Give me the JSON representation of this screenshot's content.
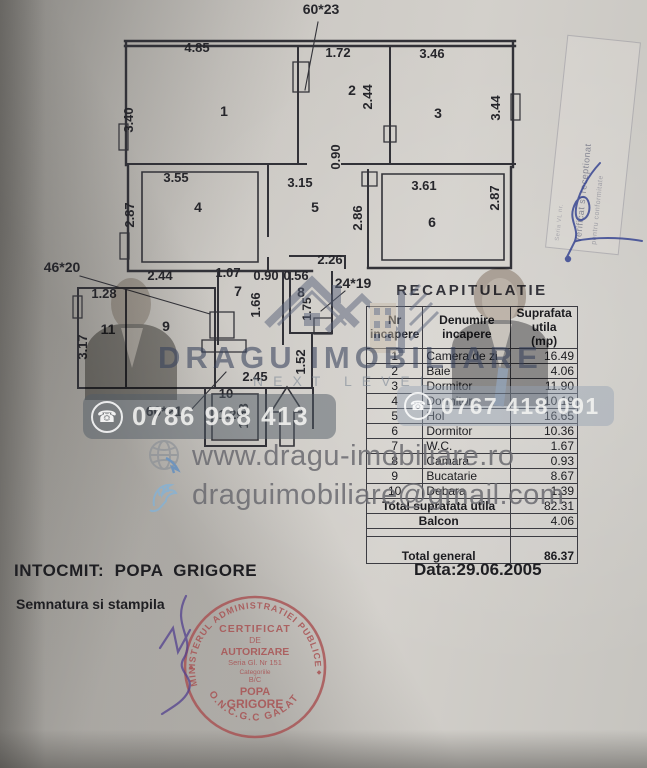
{
  "plan": {
    "labels": [
      {
        "t": "60*23",
        "x": 321,
        "y": 14,
        "s": 14
      },
      {
        "t": "4.85",
        "x": 197,
        "y": 52
      },
      {
        "t": "1.72",
        "x": 338,
        "y": 57
      },
      {
        "t": "3.46",
        "x": 432,
        "y": 58
      },
      {
        "t": "1",
        "x": 224,
        "y": 116,
        "s": 14
      },
      {
        "t": "2",
        "x": 352,
        "y": 95,
        "s": 14
      },
      {
        "t": "3",
        "x": 438,
        "y": 118,
        "s": 14
      },
      {
        "t": "3.40",
        "x": 133,
        "y": 120,
        "r": -90
      },
      {
        "t": "2.44",
        "x": 372,
        "y": 97,
        "r": -90
      },
      {
        "t": "3.44",
        "x": 500,
        "y": 108,
        "r": -90
      },
      {
        "t": "0.90",
        "x": 340,
        "y": 157,
        "r": -90
      },
      {
        "t": "3.55",
        "x": 176,
        "y": 182
      },
      {
        "t": "3.15",
        "x": 300,
        "y": 187
      },
      {
        "t": "3.61",
        "x": 424,
        "y": 190
      },
      {
        "t": "4",
        "x": 198,
        "y": 212,
        "s": 14
      },
      {
        "t": "5",
        "x": 315,
        "y": 212,
        "s": 14
      },
      {
        "t": "6",
        "x": 432,
        "y": 227,
        "s": 14
      },
      {
        "t": "2.87",
        "x": 134,
        "y": 215,
        "r": -90
      },
      {
        "t": "2.86",
        "x": 362,
        "y": 218,
        "r": -90
      },
      {
        "t": "2.87",
        "x": 499,
        "y": 198,
        "r": -90
      },
      {
        "t": "2.44",
        "x": 160,
        "y": 280
      },
      {
        "t": "1.07",
        "x": 228,
        "y": 277
      },
      {
        "t": "0.90",
        "x": 266,
        "y": 280
      },
      {
        "t": "0.56",
        "x": 296,
        "y": 280
      },
      {
        "t": "2.26",
        "x": 330,
        "y": 264
      },
      {
        "t": "46*20",
        "x": 62,
        "y": 272,
        "s": 14
      },
      {
        "t": "1.28",
        "x": 104,
        "y": 298
      },
      {
        "t": "11",
        "x": 108,
        "y": 334,
        "s": 14
      },
      {
        "t": "9",
        "x": 166,
        "y": 331,
        "s": 14
      },
      {
        "t": "3.17",
        "x": 87,
        "y": 347,
        "r": -90
      },
      {
        "t": "7",
        "x": 238,
        "y": 296,
        "s": 14
      },
      {
        "t": "8",
        "x": 301,
        "y": 297,
        "s": 14
      },
      {
        "t": "1.66",
        "x": 260,
        "y": 305,
        "r": -90
      },
      {
        "t": "1.75",
        "x": 311,
        "y": 309,
        "r": -90,
        "s": 12
      },
      {
        "t": "24*19",
        "x": 353,
        "y": 288,
        "s": 14
      },
      {
        "t": "1.52",
        "x": 305,
        "y": 362,
        "r": -90
      },
      {
        "t": "2.45",
        "x": 255,
        "y": 381
      },
      {
        "t": "10",
        "x": 226,
        "y": 398
      },
      {
        "t": "1.29",
        "x": 231,
        "y": 419
      },
      {
        "t": "1.08",
        "x": 248,
        "y": 416,
        "r": -90
      },
      {
        "t": "60*21",
        "x": 164,
        "y": 416,
        "s": 14
      }
    ]
  },
  "table": {
    "title": "RECAPITULATIE",
    "headers": {
      "col1_l1": "Nr",
      "col1_l2": "incapere",
      "col2_l1": "Denumire",
      "col2_l2": "incapere",
      "col3_l1": "Suprafata utila",
      "col3_l2": "(mp)"
    },
    "rows": [
      {
        "nr": "1",
        "name": "Camera de zi",
        "area": "16.49"
      },
      {
        "nr": "2",
        "name": "Baie",
        "area": "4.06"
      },
      {
        "nr": "3",
        "name": "Dormitor",
        "area": "11.90"
      },
      {
        "nr": "4",
        "name": "Dormitor",
        "area": "10.19"
      },
      {
        "nr": "5",
        "name": "Hol",
        "area": "16.65"
      },
      {
        "nr": "6",
        "name": "Dormitor",
        "area": "10.36"
      },
      {
        "nr": "7",
        "name": "W.C.",
        "area": "1.67"
      },
      {
        "nr": "8",
        "name": "Camara",
        "area": "0.93"
      },
      {
        "nr": "9",
        "name": "Bucatarie",
        "area": "8.67"
      },
      {
        "nr": "10",
        "name": "Debara",
        "area": "1.39"
      }
    ],
    "totals": {
      "utila_label": "Total suprafata utila",
      "utila": "82.31",
      "balcon_label": "Balcon",
      "balcon": "4.06",
      "general_label": "Total  general",
      "general": "86.37"
    }
  },
  "watermark": {
    "brand": "DRAGU IMOBILIARE",
    "tagline": "NEXT LEVEL",
    "phone_left": "0786 968 413",
    "phone_right": "0767 418 091",
    "phone_icon": "☎",
    "website": "www.dragu-imobiliare.ro",
    "email": "draguimobiliare@gmail.com"
  },
  "footer": {
    "intocmit": "INTOCMIT:  POPA  GRIGORE",
    "date": "Data:29.06.2005",
    "semnatura": "Semnatura si stampila"
  },
  "stamp": {
    "arc_top": "MINISTERUL ADMINISTRATIEI PUBLICE",
    "arc_bottom": "O.N.C.G.C  GALATI",
    "line1": "CERTIFICAT",
    "line2": "DE",
    "line3": "AUTORIZARE",
    "line4": "Seria Gl. Nr 151",
    "line5": "Categoriile",
    "line6": "B/C",
    "line7": "POPA",
    "line8": "GRIGORE",
    "diamond": "◆"
  },
  "side_stamp": {
    "line1": "Verificat si receptionat",
    "line2": "pentru conformitate",
    "line3": "Seria VL nr."
  },
  "colors": {
    "paper": "#c9c6c1",
    "ink": "#2b2b2f",
    "stamp_red": "#a84f50",
    "signature_purple": "#53418f",
    "signature_blue": "#2f3e8f",
    "brand_blue": "#3e4a63",
    "icon_blue": "#4c86c6"
  }
}
